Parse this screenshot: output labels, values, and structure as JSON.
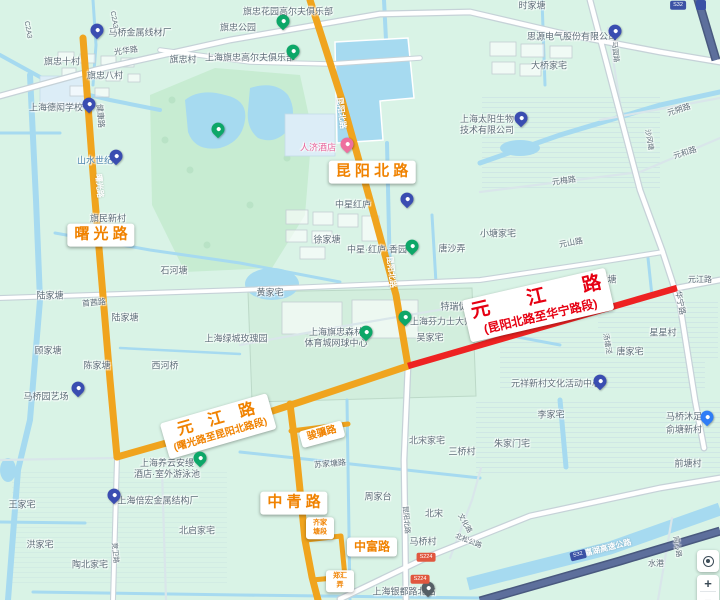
{
  "colors": {
    "bg": "#d9f3e6",
    "water": "#a6daf0",
    "park": "#c7ecd2",
    "park2": "#d2eedd",
    "yellow": "#f0a41e",
    "red": "#ee2222",
    "casing": "#c6d2d8",
    "roadwhite": "#ffffff",
    "minor": "#d9e6ea",
    "expwy": "#49597f",
    "expwyInner": "#5d6f9c",
    "labelOrange": "#f08200",
    "labelRed": "#e60012",
    "poi": "#5d6d78",
    "buildingStroke": "#c3ced2",
    "blueblock": "#dcedf7",
    "blueblockStroke": "#c4dbe8",
    "pondStroke": "#ffffff"
  },
  "road_labels": [
    {
      "name": "roadlabel-shuguang-road",
      "kind": "orange",
      "text": "曙 光 路",
      "x": 101,
      "y": 235,
      "rot": 0,
      "fs": 15
    },
    {
      "name": "roadlabel-kunyang-north-road",
      "kind": "orange",
      "text": "昆 阳 北 路",
      "x": 372,
      "y": 172,
      "rot": 0,
      "fs": 15
    },
    {
      "name": "roadlabel-yuanjiang-west-section",
      "kind": "orange",
      "text": "元　江　路",
      "sub": "(曙光路至昆阳北路段)",
      "x": 218,
      "y": 426,
      "rot": -16,
      "fs": 16,
      "sfs": 10
    },
    {
      "name": "roadlabel-zhongqing-road",
      "kind": "orange",
      "text": "中 青 路",
      "x": 294,
      "y": 503,
      "rot": 0,
      "fs": 15
    },
    {
      "name": "roadlabel-zhongfu-road",
      "kind": "orange",
      "text": "中富路",
      "x": 372,
      "y": 547,
      "rot": 0,
      "fs": 12
    },
    {
      "name": "roadlabel-junji-road",
      "kind": "orange",
      "text": "骏骥路",
      "x": 322,
      "y": 434,
      "rot": -15,
      "fs": 10
    },
    {
      "name": "roadlabel-qijiatang-section",
      "kind": "orange",
      "text": "齐家\n塘段",
      "x": 320,
      "y": 528,
      "rot": 0,
      "fs": 7
    },
    {
      "name": "roadlabel-zhenghui-lane",
      "kind": "orange",
      "text": "郑汇\n弄",
      "x": 340,
      "y": 581,
      "rot": 0,
      "fs": 7
    },
    {
      "name": "roadlabel-yuanjiang-east-section",
      "kind": "red",
      "text": "元　　江　　路",
      "sub": "(昆阳北路至华宁路段)",
      "x": 538,
      "y": 305,
      "rot": -13,
      "fs": 19,
      "sfs": 12
    }
  ],
  "poi_labels": [
    {
      "t": "旗忠花园高尔夫俱乐部",
      "x": 288,
      "y": 12
    },
    {
      "t": "旗忠公园",
      "x": 238,
      "y": 28
    },
    {
      "t": "上海旗忠高尔夫俱乐部",
      "x": 250,
      "y": 58
    },
    {
      "t": "马桥金属线材厂",
      "x": 140,
      "y": 33
    },
    {
      "t": "光华路",
      "x": 126,
      "y": 51,
      "rot": -8,
      "fs": 8
    },
    {
      "t": "旗忠村",
      "x": 183,
      "y": 60
    },
    {
      "t": "旗忠十村",
      "x": 62,
      "y": 62
    },
    {
      "t": "旗忠八村",
      "x": 105,
      "y": 76
    },
    {
      "t": "上海德闳学校",
      "x": 56,
      "y": 108
    },
    {
      "t": "健康路",
      "x": 100,
      "y": 116,
      "rot": 85,
      "fs": 8
    },
    {
      "t": "山水世纪",
      "x": 95,
      "y": 161,
      "c": "#4a84ad"
    },
    {
      "t": "人济酒店",
      "x": 318,
      "y": 148,
      "c": "#e8659a"
    },
    {
      "t": "昆阳北路",
      "x": 341,
      "y": 113,
      "rot": 83,
      "c": "#ffffff",
      "fs": 8
    },
    {
      "t": "昆阳北路",
      "x": 391,
      "y": 272,
      "rot": 83,
      "c": "#ffffff",
      "fs": 8
    },
    {
      "t": "曙光路",
      "x": 99,
      "y": 186,
      "rot": 85,
      "c": "#ffffff",
      "fs": 8
    },
    {
      "t": "中星红庐",
      "x": 353,
      "y": 205
    },
    {
      "t": "中星·红庐·香园",
      "x": 377,
      "y": 250
    },
    {
      "t": "徐家塘",
      "x": 327,
      "y": 240
    },
    {
      "t": "唐沙弄",
      "x": 452,
      "y": 249
    },
    {
      "t": "黄家宅",
      "x": 270,
      "y": 293
    },
    {
      "t": "上海绿城玫瑰园",
      "x": 236,
      "y": 339
    },
    {
      "t": "上海旗忠森林\n体育城网球中心",
      "x": 336,
      "y": 338
    },
    {
      "t": "上海芬力士大师赛",
      "x": 446,
      "y": 322
    },
    {
      "t": "特瑞促进区",
      "x": 463,
      "y": 307
    },
    {
      "t": "吴家宅",
      "x": 430,
      "y": 338
    },
    {
      "t": "小塘家宅",
      "x": 498,
      "y": 234
    },
    {
      "t": "元山路",
      "x": 571,
      "y": 243,
      "rot": -10,
      "fs": 8
    },
    {
      "t": "沈家塘",
      "x": 603,
      "y": 280
    },
    {
      "t": "元江路",
      "x": 700,
      "y": 280,
      "fs": 8
    },
    {
      "t": "华宁路",
      "x": 680,
      "y": 303,
      "rot": 78,
      "fs": 8
    },
    {
      "t": "星星村",
      "x": 663,
      "y": 333
    },
    {
      "t": "汤塘泾",
      "x": 606,
      "y": 344,
      "rot": 80,
      "fs": 7
    },
    {
      "t": "唐家宅",
      "x": 630,
      "y": 352
    },
    {
      "t": "元祥新村文化活动中心",
      "x": 556,
      "y": 384
    },
    {
      "t": "元朔路",
      "x": 679,
      "y": 110,
      "rot": -18,
      "fs": 8
    },
    {
      "t": "元和路",
      "x": 685,
      "y": 153,
      "rot": -18,
      "fs": 8
    },
    {
      "t": "元梅路",
      "x": 564,
      "y": 181,
      "rot": -8,
      "fs": 8
    },
    {
      "t": "沙冈塘",
      "x": 648,
      "y": 140,
      "rot": 80,
      "fs": 7
    },
    {
      "t": "马园路",
      "x": 614,
      "y": 52,
      "rot": 84,
      "fs": 7
    },
    {
      "t": "时家塘",
      "x": 532,
      "y": 6
    },
    {
      "t": "思源电气股份有限公司",
      "x": 572,
      "y": 37
    },
    {
      "t": "大桥家宅",
      "x": 549,
      "y": 66
    },
    {
      "t": "上海太阳生物\n技术有限公司",
      "x": 487,
      "y": 125
    },
    {
      "t": "石河塘",
      "x": 174,
      "y": 271
    },
    {
      "t": "旗民新村",
      "x": 108,
      "y": 219
    },
    {
      "t": "陆家塘",
      "x": 50,
      "y": 296
    },
    {
      "t": "陆家塘",
      "x": 125,
      "y": 318
    },
    {
      "t": "首茜路",
      "x": 94,
      "y": 303,
      "rot": -5,
      "fs": 8
    },
    {
      "t": "顾家塘",
      "x": 48,
      "y": 351
    },
    {
      "t": "陈家塘",
      "x": 97,
      "y": 366
    },
    {
      "t": "西河桥",
      "x": 165,
      "y": 366
    },
    {
      "t": "马桥园艺场",
      "x": 46,
      "y": 397
    },
    {
      "t": "上海养云安缦\n酒店·室外游泳池",
      "x": 167,
      "y": 469
    },
    {
      "t": "王家宅",
      "x": 22,
      "y": 505
    },
    {
      "t": "洪家宅",
      "x": 40,
      "y": 545
    },
    {
      "t": "上海倍宏金属结构厂",
      "x": 158,
      "y": 501
    },
    {
      "t": "陶北家宅",
      "x": 90,
      "y": 565
    },
    {
      "t": "北启家宅",
      "x": 197,
      "y": 531
    },
    {
      "t": "竞卫路",
      "x": 114,
      "y": 553,
      "rot": 85,
      "fs": 7
    },
    {
      "t": "苏家塘路",
      "x": 330,
      "y": 464,
      "rot": -5,
      "fs": 8
    },
    {
      "t": "周家台",
      "x": 378,
      "y": 497
    },
    {
      "t": "北宋家宅",
      "x": 427,
      "y": 441
    },
    {
      "t": "三桥村",
      "x": 462,
      "y": 452
    },
    {
      "t": "马桥村",
      "x": 423,
      "y": 542
    },
    {
      "t": "北宋",
      "x": 434,
      "y": 514
    },
    {
      "t": "昆阳北路",
      "x": 405,
      "y": 520,
      "rot": 85,
      "fs": 7
    },
    {
      "t": "文化路",
      "x": 464,
      "y": 524,
      "rot": 60,
      "fs": 7
    },
    {
      "t": "北松公路",
      "x": 468,
      "y": 542,
      "rot": 22,
      "fs": 7
    },
    {
      "t": "俞塘新村",
      "x": 684,
      "y": 430
    },
    {
      "t": "前塘村",
      "x": 688,
      "y": 464
    },
    {
      "t": "李家宅",
      "x": 551,
      "y": 415
    },
    {
      "t": "朱家门宅",
      "x": 512,
      "y": 444
    },
    {
      "t": "马桥沐足",
      "x": 684,
      "y": 417
    },
    {
      "t": "同心路",
      "x": 676,
      "y": 547,
      "rot": 80,
      "fs": 7
    },
    {
      "t": "水港",
      "x": 656,
      "y": 564,
      "fs": 8
    },
    {
      "t": "申嘉湖高速公路",
      "x": 604,
      "y": 549,
      "rot": -14,
      "c": "#ffffff",
      "fs": 8
    },
    {
      "t": "上海银都路北站",
      "x": 404,
      "y": 592
    },
    {
      "t": "C2A3",
      "x": 27,
      "y": 30,
      "rot": 80,
      "fs": 7
    },
    {
      "t": "C2A3",
      "x": 113,
      "y": 20,
      "rot": 80,
      "fs": 7
    }
  ],
  "markers": [
    {
      "k": "green",
      "x": 283,
      "y": 25,
      "name": "marker-qizhong-park"
    },
    {
      "k": "green",
      "x": 293,
      "y": 55,
      "name": "marker-qizhong-golf-club"
    },
    {
      "k": "green",
      "x": 218,
      "y": 133,
      "name": "marker-golf-garden"
    },
    {
      "k": "navy",
      "x": 97,
      "y": 34,
      "name": "marker-maqiao-metal-wire-factory"
    },
    {
      "k": "navy",
      "x": 89,
      "y": 108,
      "name": "marker-dehong-school"
    },
    {
      "k": "navy",
      "x": 116,
      "y": 160,
      "name": "marker-shanshui-century"
    },
    {
      "k": "pink",
      "x": 347,
      "y": 148,
      "name": "marker-renji-hotel"
    },
    {
      "k": "navy",
      "x": 615,
      "y": 35,
      "name": "marker-siyuan-electric"
    },
    {
      "k": "navy",
      "x": 521,
      "y": 122,
      "name": "marker-sun-biotech"
    },
    {
      "k": "navy",
      "x": 407,
      "y": 203,
      "name": "marker-zhongxing-honglu"
    },
    {
      "k": "green",
      "x": 412,
      "y": 250,
      "name": "marker-zhongxing-garden"
    },
    {
      "k": "green",
      "x": 405,
      "y": 321,
      "name": "marker-fenlishi-masters"
    },
    {
      "k": "green",
      "x": 366,
      "y": 336,
      "name": "marker-tennis-center"
    },
    {
      "k": "green",
      "x": 200,
      "y": 462,
      "name": "marker-amanyangyun-pool"
    },
    {
      "k": "navy",
      "x": 78,
      "y": 392,
      "name": "marker-maqiao-nursery"
    },
    {
      "k": "navy",
      "x": 114,
      "y": 499,
      "name": "marker-beihong-metal-factory"
    },
    {
      "k": "navy",
      "x": 600,
      "y": 385,
      "name": "marker-yuanxiang-culture-center"
    },
    {
      "k": "blue",
      "x": 707,
      "y": 421,
      "name": "marker-maqiao-muzu"
    },
    {
      "k": "dark",
      "x": 428,
      "y": 592,
      "name": "marker-bus-station"
    }
  ],
  "badges": [
    {
      "t": "S224",
      "x": 426,
      "y": 557,
      "bg": "#e0573f",
      "name": "road-shield-s224"
    },
    {
      "t": "S224",
      "x": 420,
      "y": 579,
      "bg": "#e0573f",
      "name": "road-shield-s224"
    },
    {
      "t": "S32",
      "x": 678,
      "y": 5,
      "bg": "#3b52a5",
      "name": "expressway-shield"
    },
    {
      "t": "S32",
      "x": 578,
      "y": 555,
      "bg": "#3b52a5",
      "rot": -14,
      "name": "expressway-shield"
    },
    {
      "grid": true,
      "x": 701,
      "y": 5,
      "bg": "#3b52a5",
      "name": "expressway-entrance-icon"
    }
  ],
  "controls": {
    "zoom_in": "+",
    "zoom_out": "−"
  }
}
